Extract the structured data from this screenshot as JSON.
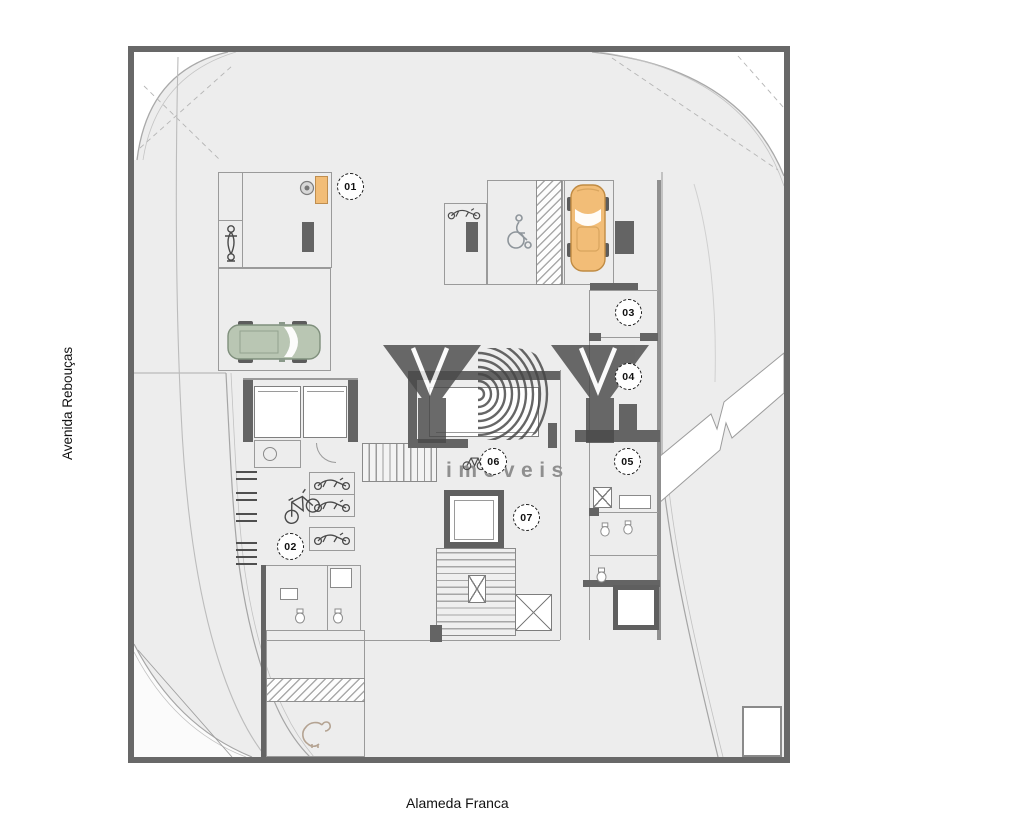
{
  "plan": {
    "street_left": "Avenida Rebouças",
    "street_bottom": "Alameda Franca",
    "watermark_brand": "YBY",
    "watermark_word": "imóveis",
    "unit_markers": [
      {
        "label": "01"
      },
      {
        "label": "02"
      },
      {
        "label": "03"
      },
      {
        "label": "04"
      },
      {
        "label": "05"
      },
      {
        "label": "06"
      },
      {
        "label": "07"
      }
    ],
    "colors": {
      "frame_border": "#686868",
      "floor": "#ededed",
      "wall_thin": "#9a9a9a",
      "wall_dark": "#646464",
      "car_orange": "#f2bd77",
      "car_green": "#b9c6b3",
      "locker_orange": "#f2bd77",
      "watermark_gray": "#4a4a4a",
      "watermark_word_gray": "#8f8f8f"
    },
    "icons": [
      "motorcycle-icon",
      "bicycle-icon",
      "wheelchair-icon",
      "dog-icon",
      "car-icon",
      "bike-rack-icon",
      "elevator-cabin",
      "stairs",
      "x-shaft"
    ]
  }
}
